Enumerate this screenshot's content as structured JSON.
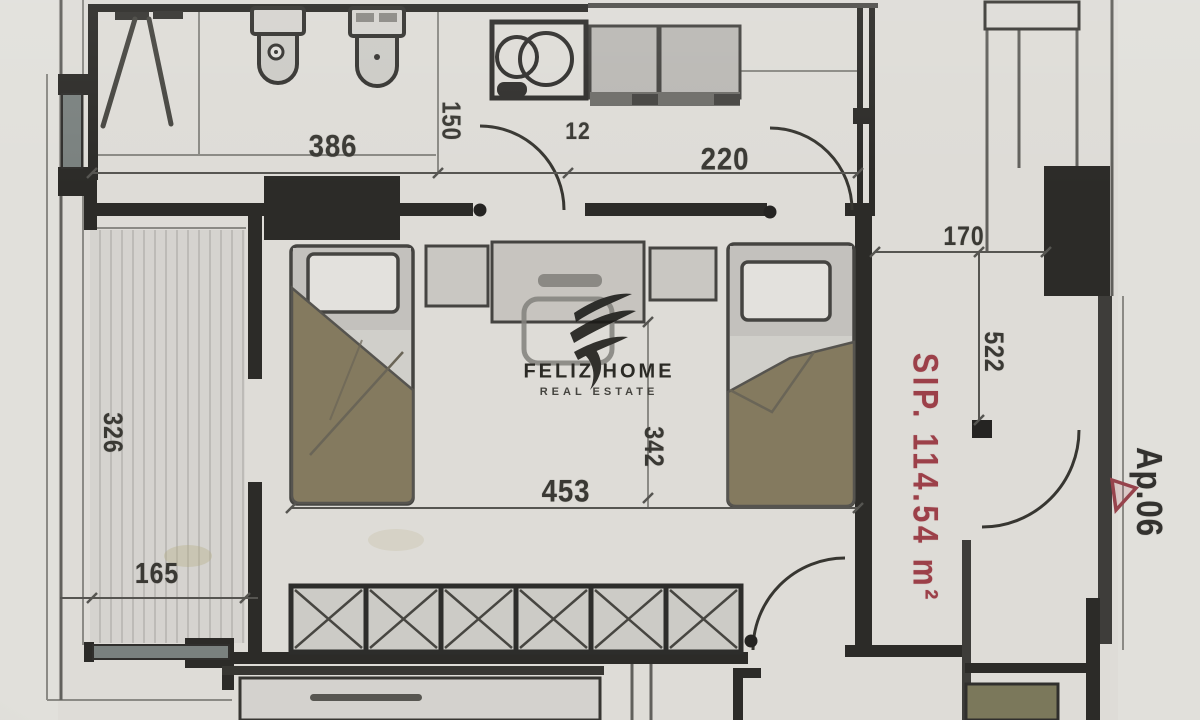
{
  "plan": {
    "watermark": {
      "brand": "FELIZ HOME",
      "tagline": "REAL ESTATE"
    },
    "area_label": "SIP. 114.54 m²",
    "apartment_label": "Ap.06",
    "dimensions": {
      "bathroom_width": "386",
      "bathroom_depth": "150",
      "door_gap": "12",
      "kitchen_width": "220",
      "hall_width": "170",
      "hall_length": "522",
      "bedroom_width": "453",
      "bedroom_length": "342",
      "balcony_length": "326",
      "balcony_width": "165"
    },
    "colors": {
      "paper": "#dedcd7",
      "wall-dark": "#292825",
      "accent-red": "#9c4049",
      "blanket-olive": "#857a5c",
      "door-olive": "#7b7857",
      "window-glass": "#79817f"
    }
  }
}
